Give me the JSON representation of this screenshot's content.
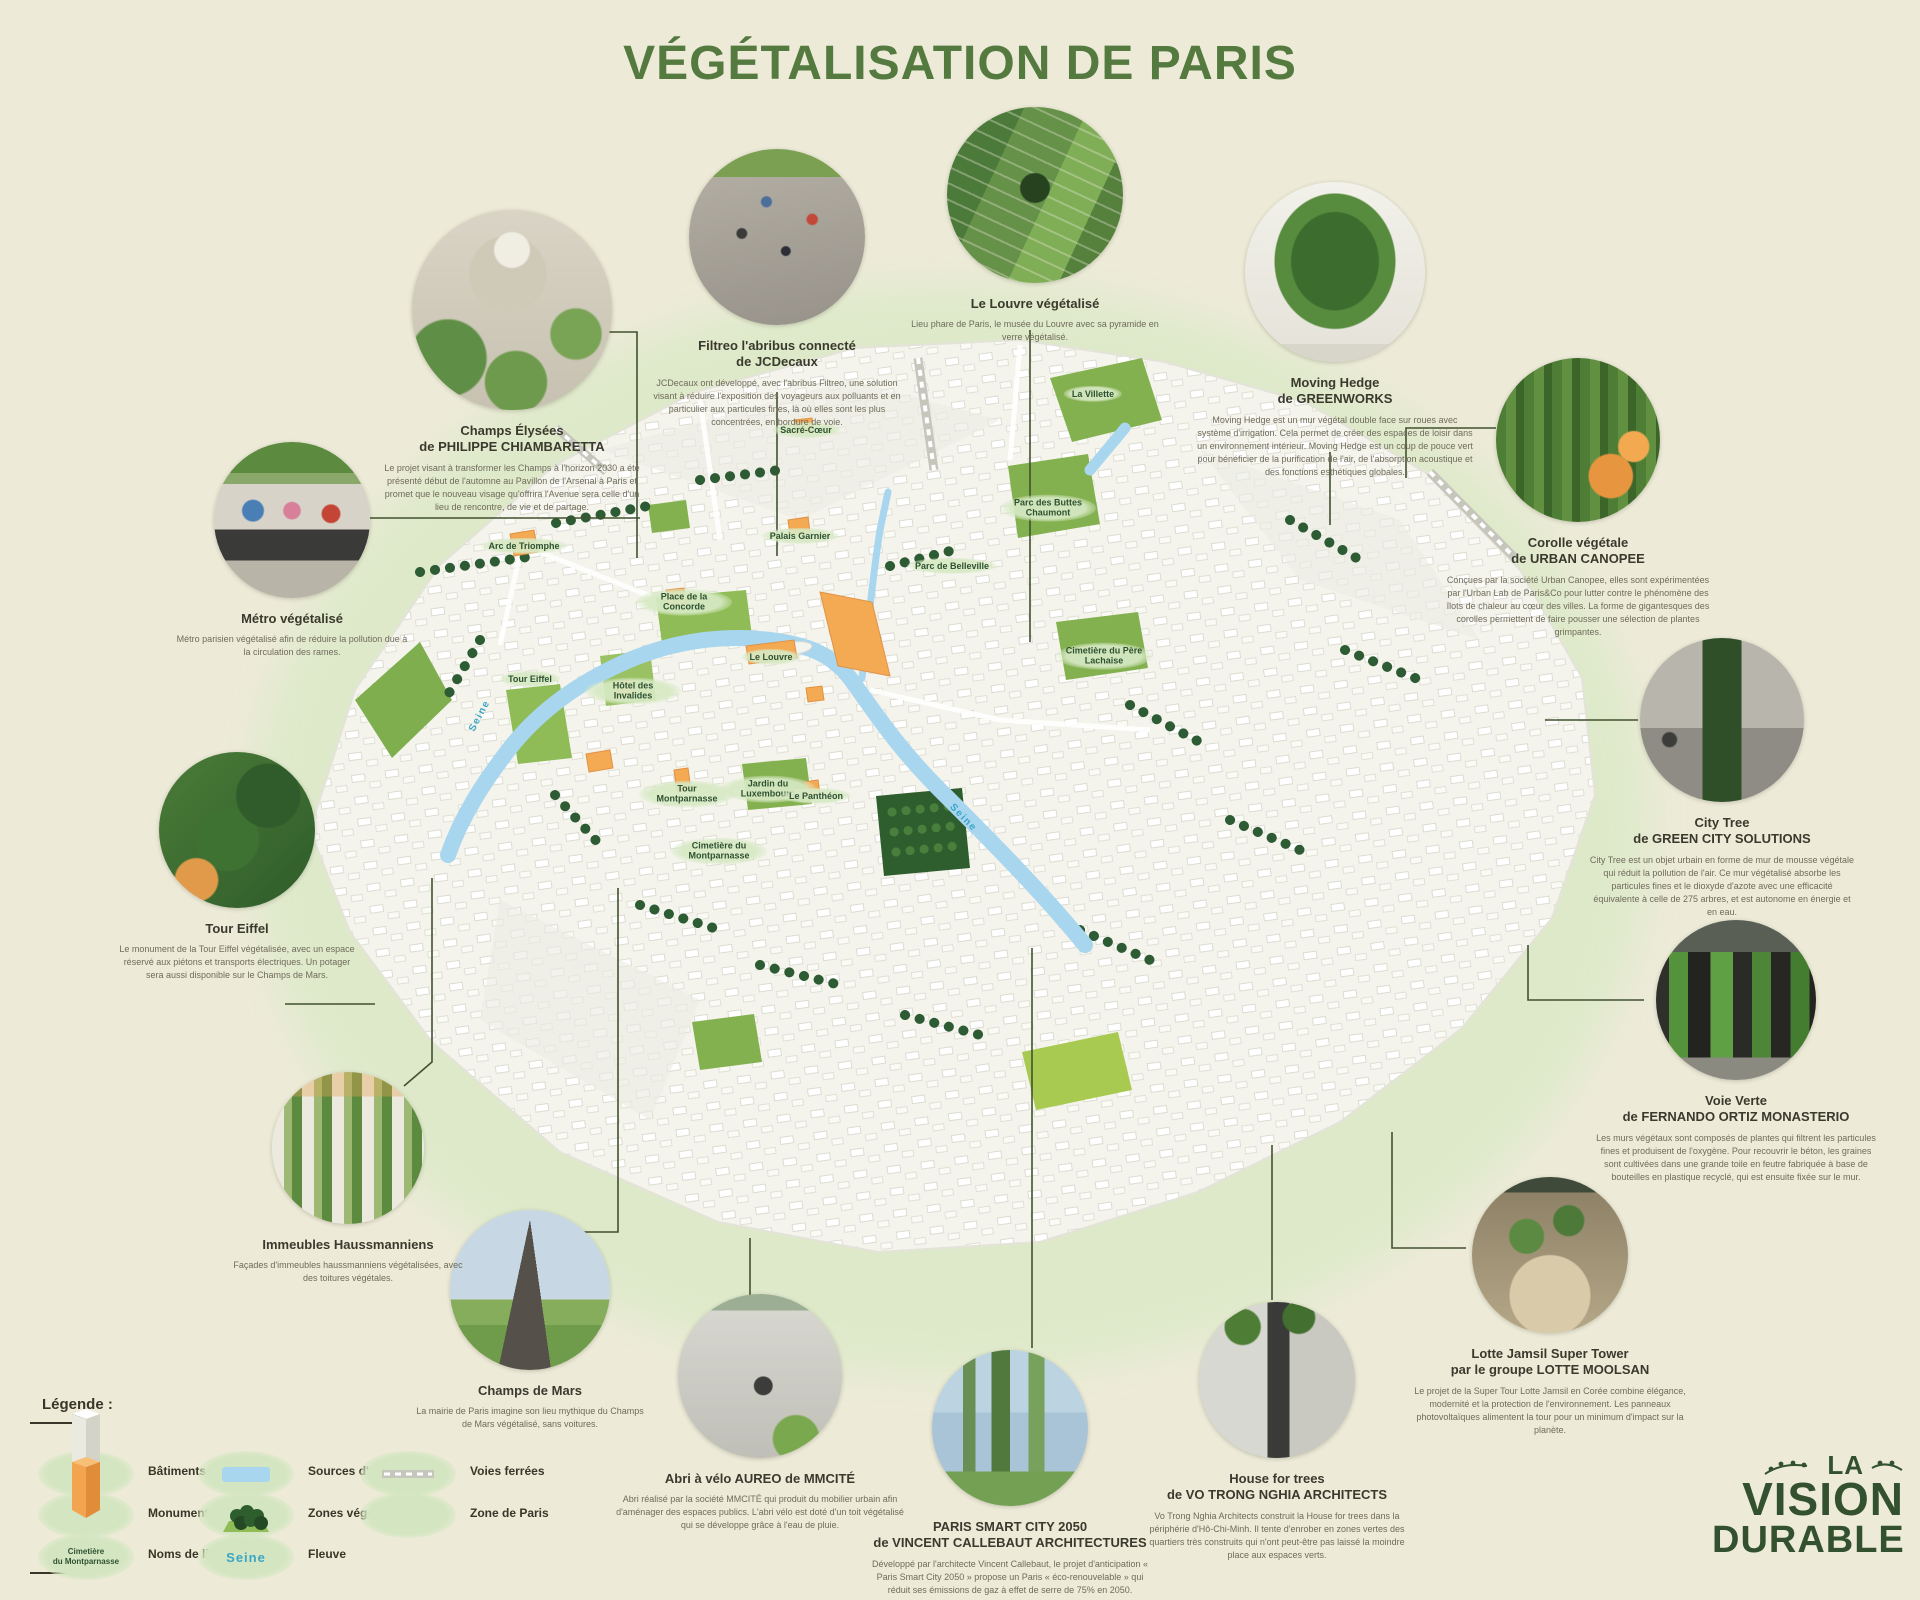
{
  "poster": {
    "title": "VÉGÉTALISATION DE PARIS"
  },
  "colors": {
    "background": "#edebd8",
    "title_green": "#547a40",
    "building": "#f7f7f1",
    "monument_orange": "#f4a953",
    "water_blue": "#a9d6ef",
    "vegetation_dark": "#2d5b33",
    "park_green": "#84b150",
    "zone_glow": "#dce9c8",
    "seine_label": "#3aa6c6",
    "text_dark": "#3a392f"
  },
  "callouts": [
    {
      "title1": "Champs Élysées",
      "title2": "de PHILIPPE CHIAMBARETTA",
      "desc": "Le projet visant à transformer les Champs à l'horizon 2030 a été présenté début de l'automne au Pavillon de l'Arsenal à Paris et promet que le nouveau visage qu'offrira l'Avenue sera celle d'un lieu de rencontre, de vie et de partage."
    },
    {
      "title1": "Filtreo l'abribus connecté",
      "title2": "de JCDecaux",
      "desc": "JCDecaux ont développé, avec l'abribus Filtreo, une solution visant à réduire l'exposition des voyageurs aux polluants et en particulier aux particules fines, là où elles sont les plus concentrées, en bordure de voie."
    },
    {
      "title1": "Le Louvre végétalisé",
      "desc": "Lieu phare de Paris, le musée du Louvre avec sa pyramide en verre végétalisé."
    },
    {
      "title1": "Moving Hedge",
      "title2": "de GREENWORKS",
      "desc": "Moving Hedge est un mur végétal double face sur roues avec système d'irrigation. Cela permet de créer des espaces de loisir dans un environnement intérieur. Moving Hedge est un coup de pouce vert pour bénéficier de la purification de l'air, de l'absorption acoustique et des fonctions esthétiques globales."
    },
    {
      "title1": "Corolle végétale",
      "title2": "de URBAN CANOPEE",
      "desc": "Conçues par la société Urban Canopee, elles sont expérimentées par l'Urban Lab de Paris&Co pour lutter contre le phénomène des îlots de chaleur au cœur des villes. La forme de gigantesques des corolles permettent de faire pousser une sélection de plantes grimpantes."
    },
    {
      "title1": "City Tree",
      "title2": "de GREEN CITY SOLUTIONS",
      "desc": "City Tree est un objet urbain en forme de mur de mousse végétale qui réduit la pollution de l'air. Ce mur végétalisé absorbe les particules fines et le dioxyde d'azote avec une efficacité équivalente à celle de 275 arbres, et est autonome en énergie et en eau."
    },
    {
      "title1": "Voie Verte",
      "title2": "de FERNANDO ORTIZ MONASTERIO",
      "desc": "Les murs végétaux sont composés de plantes qui filtrent les particules fines et produisent de l'oxygène. Pour recouvrir le béton, les graines sont cultivées dans une grande toile en feutre fabriquée à base de bouteilles en plastique recyclé, qui est ensuite fixée sur le mur."
    },
    {
      "title1": "Lotte Jamsil Super Tower",
      "title2": "par le groupe LOTTE MOOLSAN",
      "desc": "Le projet de la Super Tour Lotte Jamsil en Corée combine élégance, modernité et la protection de l'environnement. Les panneaux photovoltaïques alimentent la tour pour un minimum d'impact sur la planète."
    },
    {
      "title1": "House for trees",
      "title2": "de VO TRONG NGHIA ARCHITECTS",
      "desc": "Vo Trong Nghia Architects construit la House for trees dans la périphérie d'Hô-Chi-Minh. Il tente d'enrober en zones vertes des quartiers très construits qui n'ont peut-être pas laissé la moindre place aux espaces verts."
    },
    {
      "title1": "PARIS SMART CITY 2050",
      "title2": "de VINCENT CALLEBAUT ARCHITECTURES",
      "desc": "Développé par l'architecte Vincent Callebaut, le projet d'anticipation « Paris Smart City 2050 » propose un Paris « éco-renouvelable » qui réduit ses émissions de gaz à effet de serre de 75% en 2050."
    },
    {
      "title1": "Abri à vélo AUREO de MMCITÉ",
      "desc": "Abri réalisé par la société MMCITÉ qui produit du mobilier urbain afin d'aménager des espaces publics. L'abri vélo est doté d'un toit végétalisé qui se développe grâce à l'eau de pluie."
    },
    {
      "title1": "Champs de Mars",
      "desc": "La mairie de Paris imagine son lieu mythique du Champs de Mars végétalisé, sans voitures."
    },
    {
      "title1": "Immeubles Haussmanniens",
      "desc": "Façades d'immeubles haussmanniens végétalisées, avec des toitures végétales."
    },
    {
      "title1": "Tour Eiffel",
      "desc": "Le monument de la Tour Eiffel végétalisée, avec un espace réservé aux piétons et transports électriques. Un potager sera aussi disponible sur le Champs de Mars."
    },
    {
      "title1": "Métro végétalisé",
      "desc": "Métro parisien végétalisé afin de réduire la pollution due à la circulation des rames."
    }
  ],
  "map": {
    "labels": [
      {
        "text": "La Villette"
      },
      {
        "text": "Parc des Buttes Chaumont"
      },
      {
        "text": "Parc de Belleville"
      },
      {
        "text": "Cimetière du Père Lachaise"
      },
      {
        "text": "Palais Garnier"
      },
      {
        "text": "Arc de Triomphe"
      },
      {
        "text": "Sacré-Cœur"
      },
      {
        "text": "Le Louvre"
      },
      {
        "text": "Place de la Concorde"
      },
      {
        "text": "Tour Eiffel"
      },
      {
        "text": "Hôtel des Invalides"
      },
      {
        "text": "Seine"
      },
      {
        "text": "Seine"
      },
      {
        "text": "Tour Montparnasse"
      },
      {
        "text": "Jardin du Luxembourg"
      },
      {
        "text": "Le Panthéon"
      },
      {
        "text": "Cimetière du Montparnasse"
      }
    ]
  },
  "legend": {
    "title": "Légende :",
    "items": [
      {
        "label": "Bâtiments"
      },
      {
        "label": "Monuments"
      },
      {
        "label": "Noms de lieux",
        "sample1": "Cimetière",
        "sample2": "du Montparnasse"
      },
      {
        "label": "Sources d'eau"
      },
      {
        "label": "Zones végétales"
      },
      {
        "label": "Fleuve",
        "sample": "Seine"
      },
      {
        "label": "Voies ferrées"
      },
      {
        "label": "Zone de Paris"
      }
    ]
  },
  "logo": {
    "la": "LA",
    "vision": "VISION",
    "durable": "DURABLE"
  }
}
